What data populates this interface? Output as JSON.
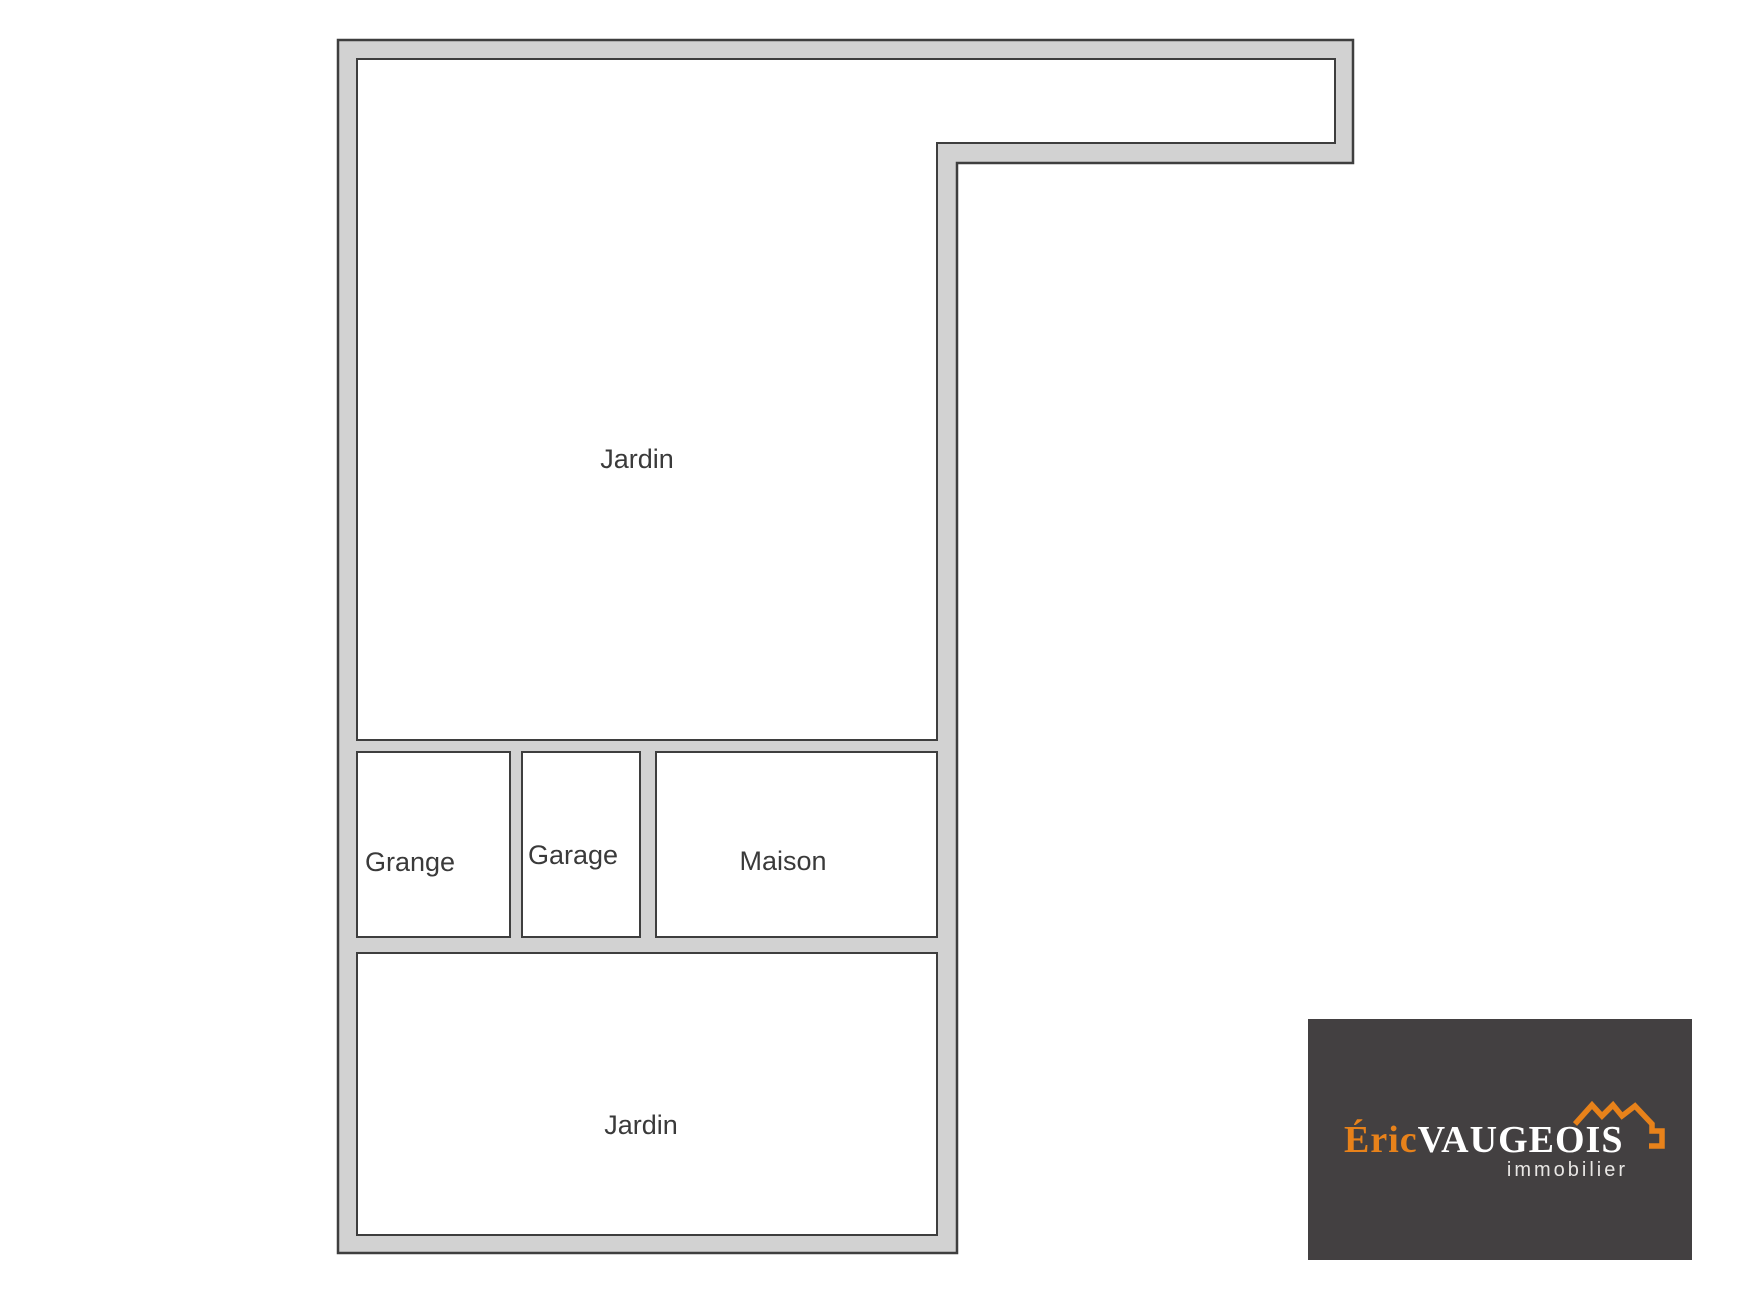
{
  "plan": {
    "areas": {
      "jardin_top": {
        "label": "Jardin"
      },
      "grange": {
        "label": "Grange"
      },
      "garage": {
        "label": "Garage"
      },
      "maison": {
        "label": "Maison"
      },
      "jardin_bottom": {
        "label": "Jardin"
      }
    }
  },
  "logo": {
    "brand_first": "Éric",
    "brand_last": "VAUGEOIS",
    "tagline": "immobilier",
    "icon": "roof-outline-icon"
  },
  "colors": {
    "wall_fill": "#d2d2d2",
    "wall_line": "#3e3e3e",
    "room_fill": "#ffffff",
    "label_color": "#3a3a3a",
    "logo_background": "#434041",
    "brand_orange": "#e8821a",
    "brand_white": "#ffffff",
    "tagline_color": "#e9e7e5",
    "page_background": "#ffffff"
  }
}
